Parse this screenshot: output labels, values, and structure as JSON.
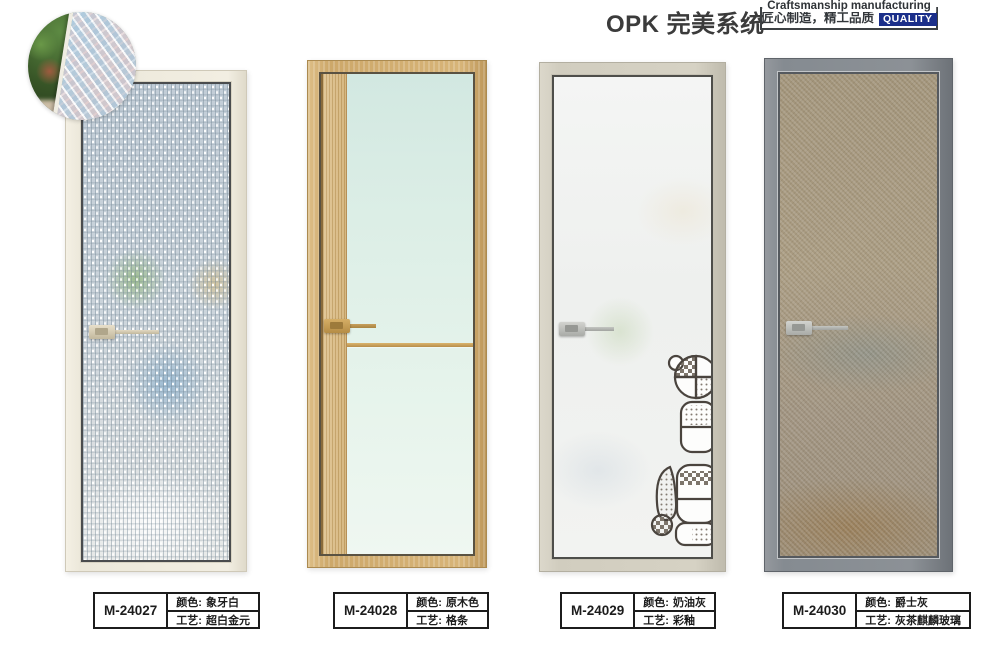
{
  "header": {
    "title": "OPK 完美系统",
    "badge": {
      "line1": "Craftsmanship manufacturing",
      "line2": "匠心制造，精工品质",
      "quality": "QUALITY"
    }
  },
  "labels": {
    "color": "颜色:",
    "craft": "工艺:"
  },
  "products": [
    {
      "model": "M-24027",
      "color": "象牙白",
      "craft": "超白金元"
    },
    {
      "model": "M-24028",
      "color": "原木色",
      "craft": "格条"
    },
    {
      "model": "M-24029",
      "color": "奶油灰",
      "craft": "彩釉"
    },
    {
      "model": "M-24030",
      "color": "爵士灰",
      "craft": "灰茶麒麟玻璃"
    }
  ],
  "colors": {
    "title_text": "#3b3b3b",
    "quality_badge_bg": "#1b2f8a",
    "door1_frame_ivory": "#f0ece0",
    "door2_frame_wood": "#d2ae72",
    "door3_frame_cream_gray": "#d3cfc1",
    "door4_frame_jazz_gray": "#84898e",
    "door4_glass_tan": "#a69878"
  }
}
